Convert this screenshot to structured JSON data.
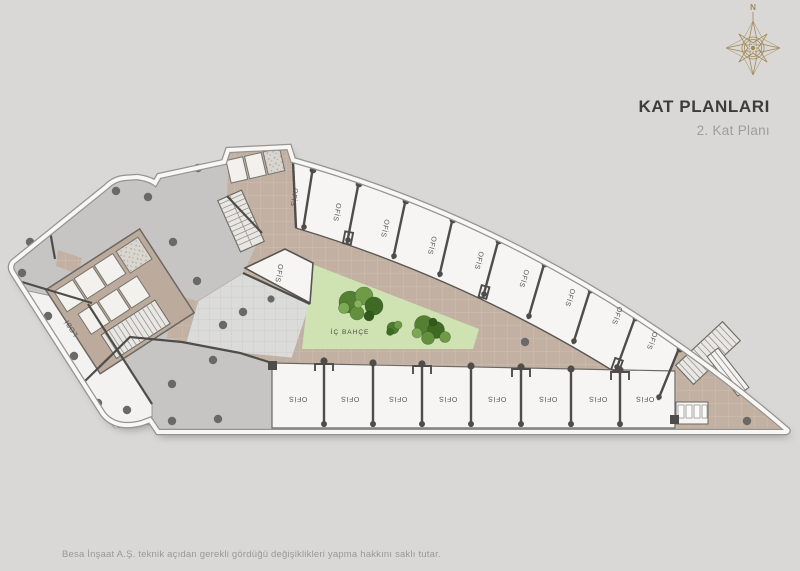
{
  "header": {
    "title": "KAT PLANLARI",
    "subtitle": "2. Kat Planı"
  },
  "compass": {
    "north": "N"
  },
  "plan": {
    "courtyard": "İÇ BAHÇE",
    "lobby": "LOBİ",
    "side_unit": "OFİS",
    "top_units": [
      "OFİS",
      "OFİS",
      "OFİS",
      "OFİS",
      "OFİS",
      "OFİS",
      "OFİS",
      "OFİS",
      "OFİS"
    ],
    "bottom_units": [
      "OFİS",
      "OFİS",
      "OFİS",
      "OFİS",
      "OFİS",
      "OFİS",
      "OFİS",
      "OFİS"
    ]
  },
  "footer": {
    "disclaimer": "Besa İnşaat A.Ş. teknik açıdan gerekli gördüğü değişiklikleri yapma hakkını saklı tutar."
  },
  "colors": {
    "background": "#d9d8d6",
    "floor_gray": "#c6c5c3",
    "corridor_tan": "#c2b1a2",
    "courtyard_green": "#cfe3b2",
    "unit_white": "#f6f5f3",
    "wall": "#4f4d49",
    "accent_gold": "#a28a58"
  }
}
